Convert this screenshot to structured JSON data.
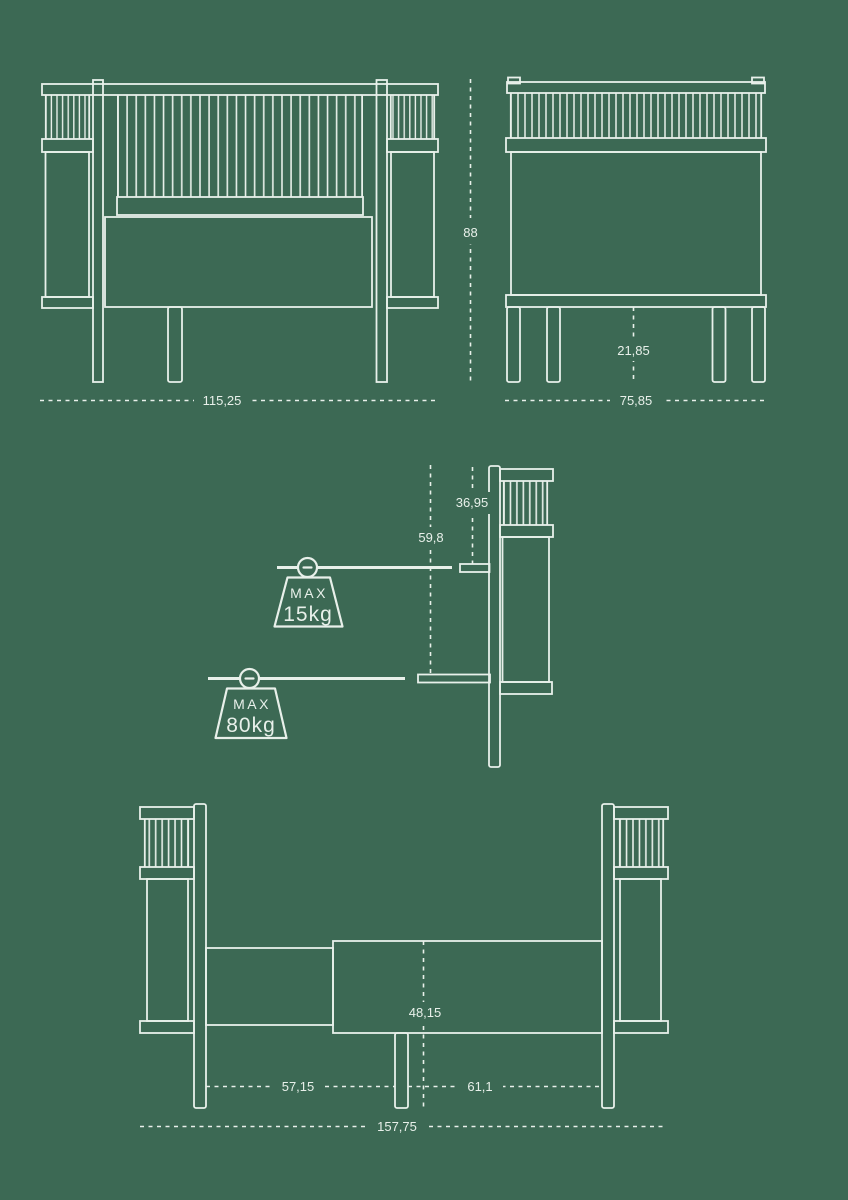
{
  "title": "crib-dimensions-diagram",
  "colors": {
    "background": "#3c6954",
    "line": "#e8f0ea"
  },
  "views": {
    "front": {
      "width": "115,25",
      "height": "88"
    },
    "side": {
      "width": "75,85",
      "leg_height": "21,85"
    },
    "profile": {
      "upper_mattress_depth": "36,95",
      "lower_mattress_depth": "59,8",
      "upper_weight_limit": {
        "label": "MAX",
        "value": "15kg"
      },
      "lower_weight_limit": {
        "label": "MAX",
        "value": "80kg"
      }
    },
    "extended": {
      "mattress_height": "48,15",
      "left_section_length": "57,15",
      "right_section_length": "61,1",
      "total_length": "157,75"
    }
  }
}
